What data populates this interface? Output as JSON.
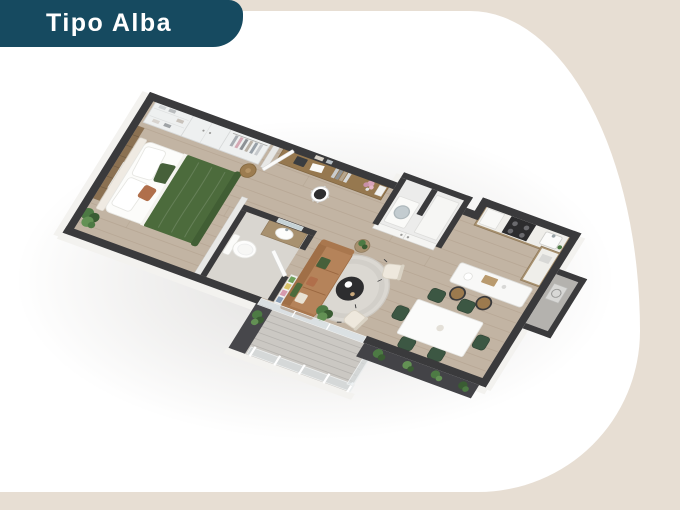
{
  "badge": {
    "label": "Tipo Alba"
  },
  "colors": {
    "badge_bg": "#164A60",
    "badge_text": "#FFFFFF",
    "canvas_beige": "#E7DED3",
    "blob_white": "#FFFFFF",
    "wall_dark": "#3A3A3C",
    "floor_wood": "#C2B4A3",
    "balcony_floor": "#CBC8C3",
    "bed_green": "#4C6B3C",
    "dining_chair_green": "#3C5743",
    "sofa_tan": "#B5835A",
    "counter_wood": "#A8916F",
    "rug_gray": "#DBD8D2",
    "plant_green": "#4D7A44"
  },
  "floorplan": {
    "rooms": [
      "bedroom",
      "closet",
      "desk-nook",
      "bathroom",
      "laundry-closet",
      "kitchen",
      "dining-area",
      "living-area",
      "balcony",
      "service-ledge"
    ]
  }
}
